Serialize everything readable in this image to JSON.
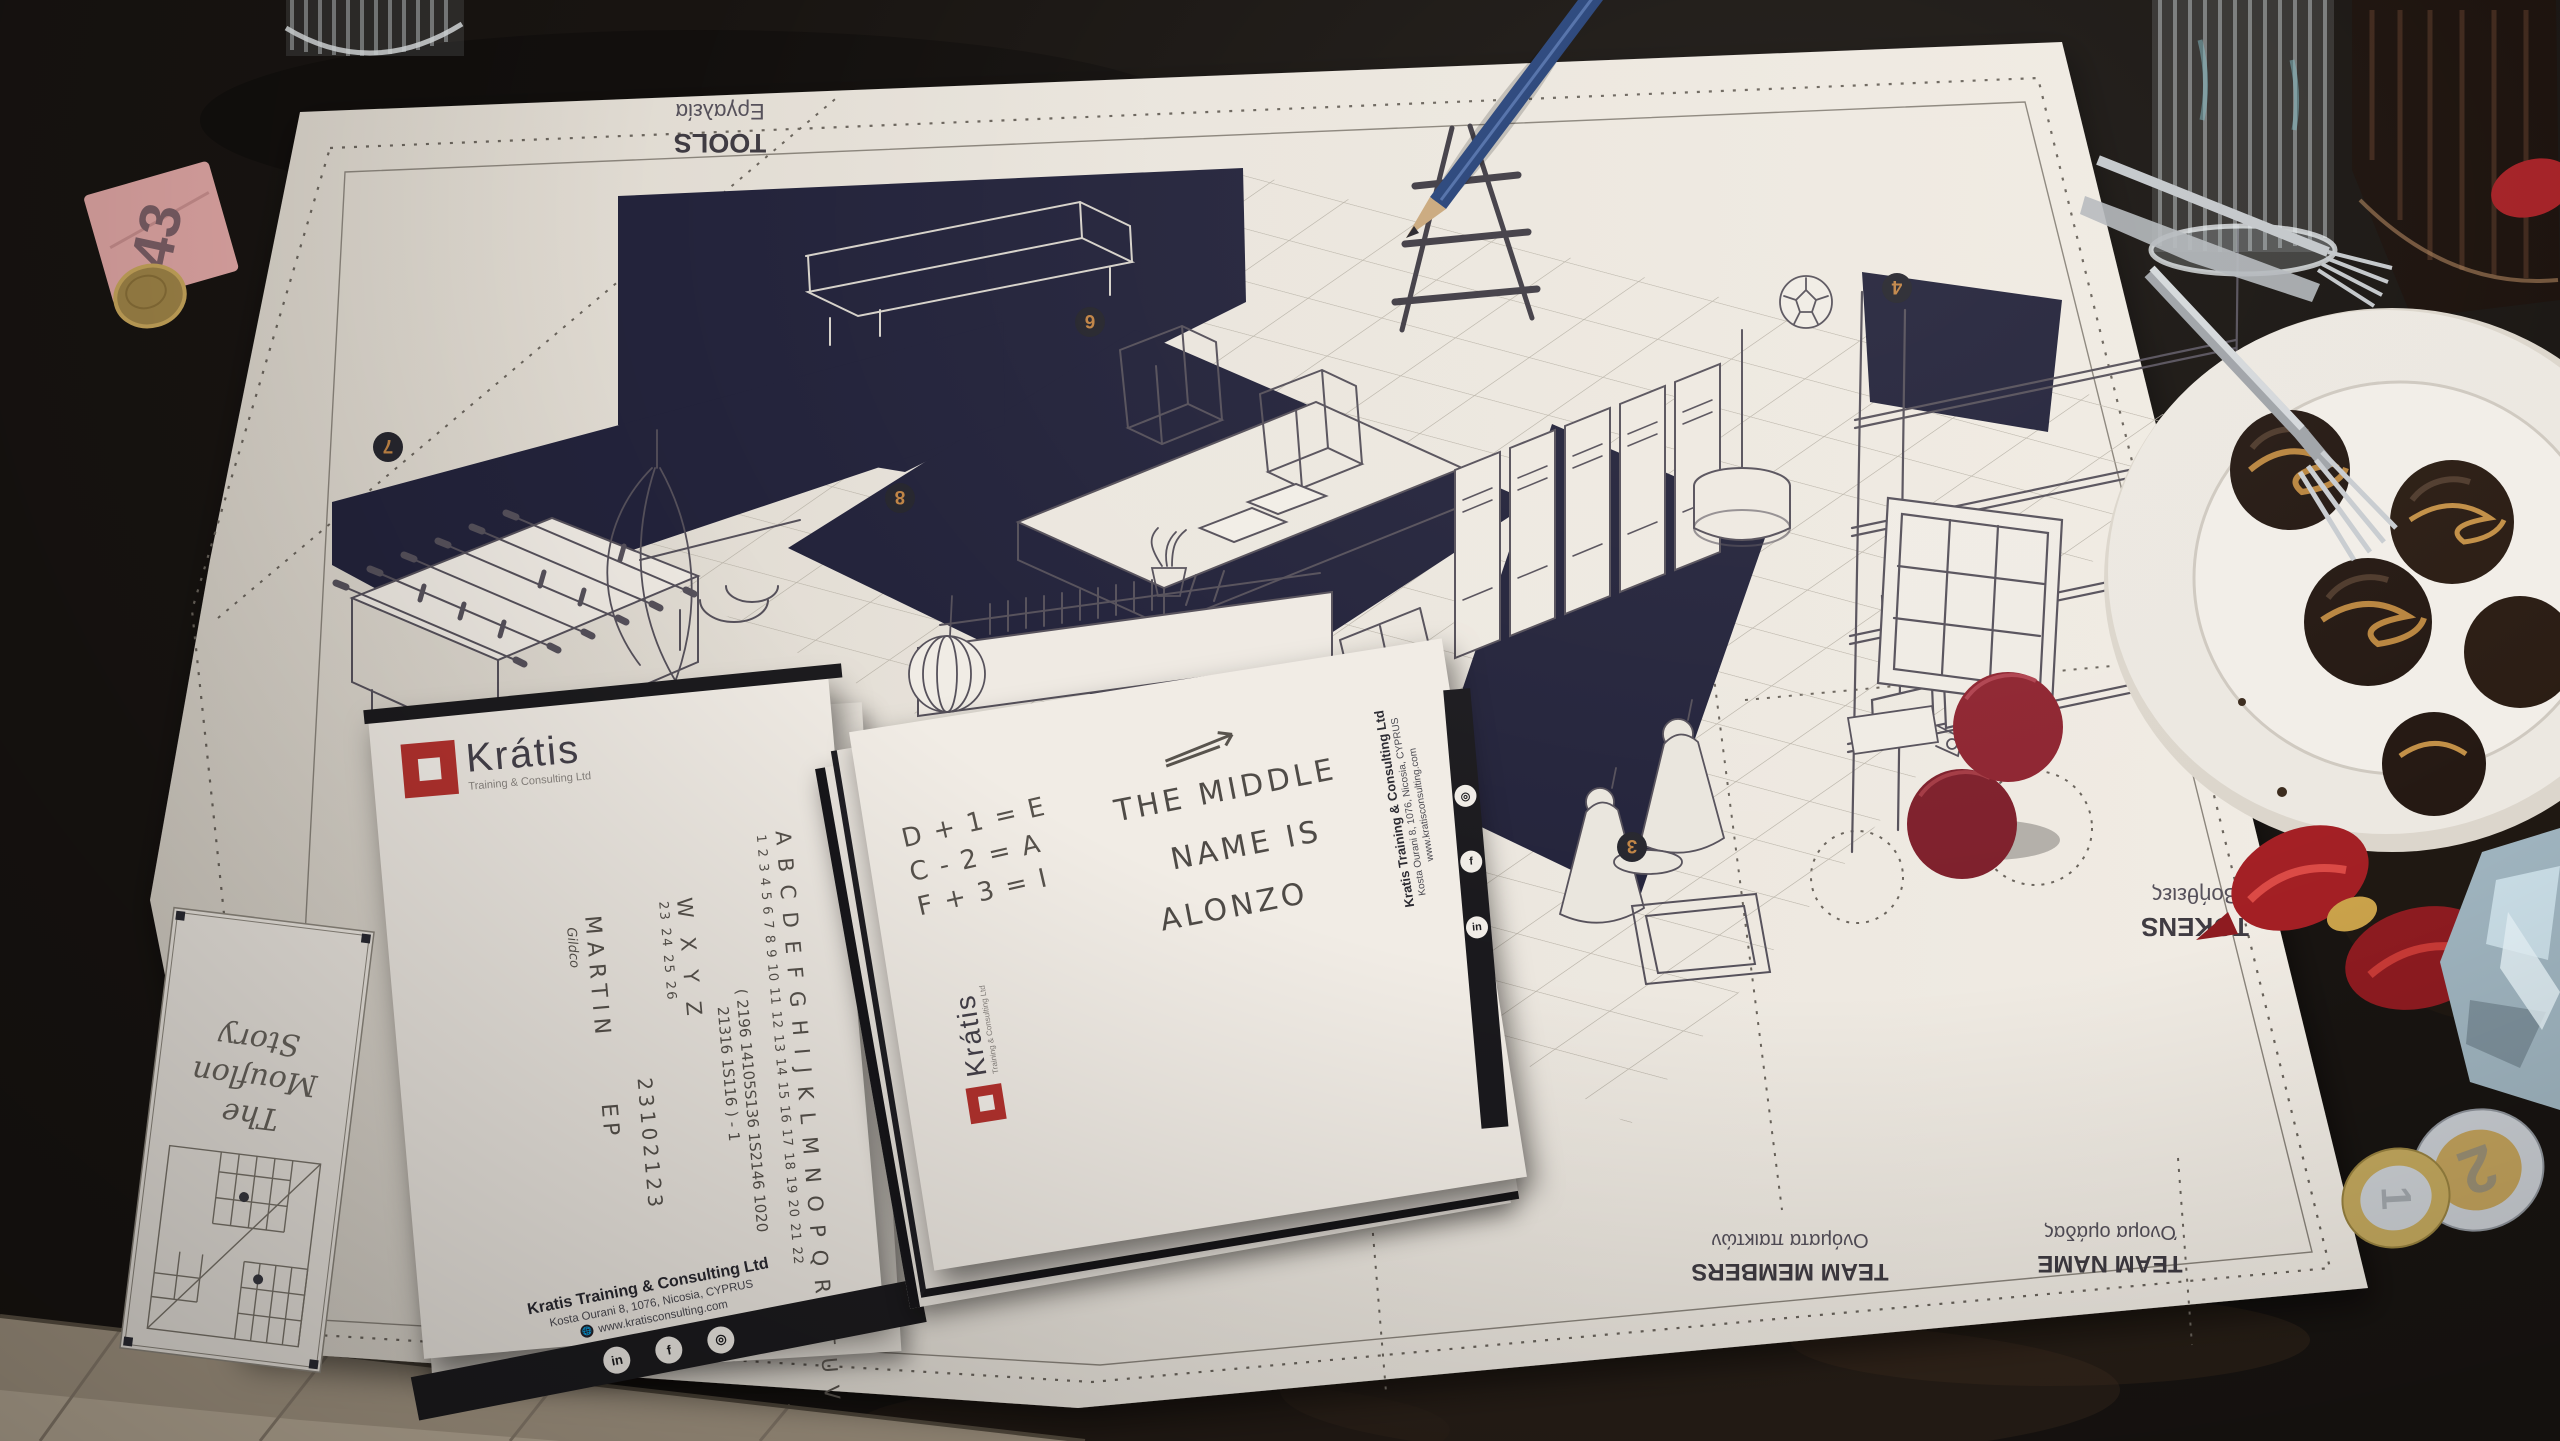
{
  "poster": {
    "sections": {
      "tools_en": "TOOLS",
      "tools_gr": "Εργαλεία",
      "tokens_en": "TOKENS",
      "tokens_gr": "Βοήθειες",
      "team_members_en": "TEAM MEMBERS",
      "team_members_gr": "Ονόματα παικτών",
      "team_name_en": "TEAM NAME",
      "team_name_gr": "Όνομα ομάδας"
    },
    "title_box": {
      "line1": "The",
      "line2": "Mouflon",
      "line3": "Story"
    },
    "badges": {
      "b3": "3",
      "b4": "4",
      "b6": "6",
      "b7": "7",
      "b8": "8"
    }
  },
  "brand": {
    "name": "Krátis",
    "tagline": "Training & Consulting Ltd",
    "footer_company": "Kratis Training & Consulting Ltd",
    "footer_address": "Kosta Ourani 8, 1076, Nicosia, CYPRUS",
    "footer_web": "www.kratisconsulting.com",
    "social": {
      "linkedin": "in",
      "facebook": "f",
      "instagram": "◎"
    }
  },
  "alphabet_card": {
    "letters": "A B C D E F G H I J K L M N O P Q R S T U V",
    "numbers": "1 2 3 4 5 6 7 8 9 10 11 12 13 14 15 16 17 18 19 20 21 22",
    "letters2": "W X Y Z",
    "numbers2": "23 24 25 26",
    "work1": "( 2196  14105S136  1S2146  1020",
    "work2": "21316 1S116 )  -  1",
    "code": "23102123",
    "name": "MARTIN",
    "name_suffix": "EP",
    "signature": "Gildco"
  },
  "clue_card": {
    "f1": "D + 1 = E",
    "f2": "C - 2 = A",
    "f3": "F + 3 = I",
    "l1": "THE MIDDLE",
    "l2": "NAME IS",
    "l3": "ALONZO"
  },
  "ticket": {
    "number": "43"
  },
  "coins": {
    "two_euro": "2",
    "one_euro": "1"
  },
  "colors": {
    "accent_red": "#b5322e",
    "navy": "#23233b",
    "token_red": "#8e2430",
    "poster": "#eee9e1"
  }
}
